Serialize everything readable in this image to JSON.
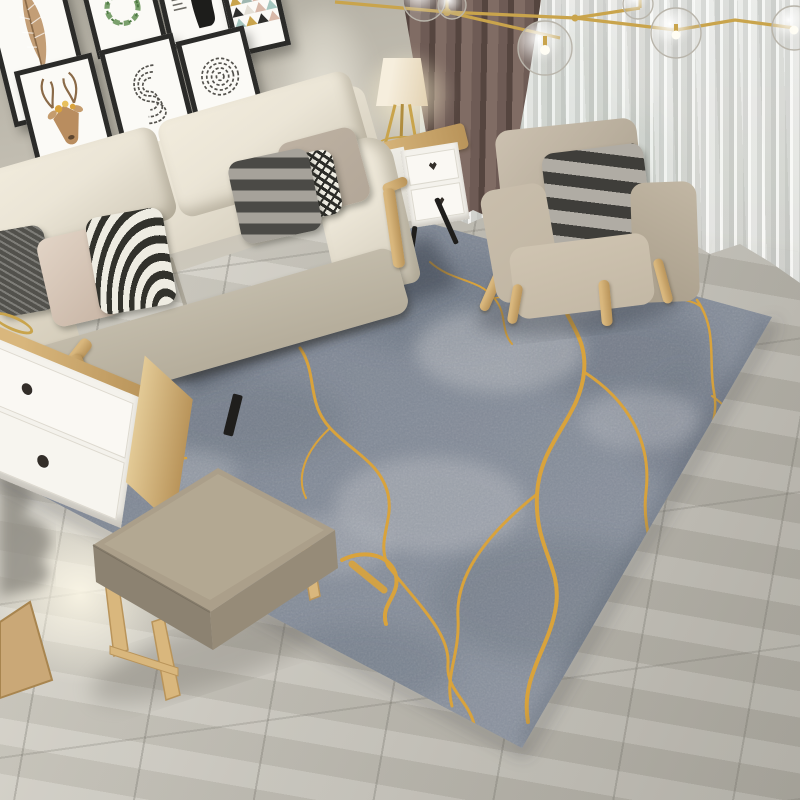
{
  "scene": {
    "description": "Modern living room product photograph showcasing a gray area rug with gold kintsugi-style marble veining, cream fabric sofa, beige armchair, ottoman, white side table with tripod lamp, gallery wall of black frames, brown blackout curtain and white sheer over a window, glass-globe branch pendant light, gray wood-tile floor",
    "focal_product": "gray and gold abstract marble rug"
  },
  "colors": {
    "wall": "#c9c4b8",
    "wall-shadow": "#b1ada1",
    "floor-light": "#dbd8ce",
    "floor-mid": "#c4c1b8",
    "floor-dark": "#a9a69d",
    "rug-base": "#7b8492",
    "rug-light": "#979eaa",
    "rug-pale": "#c6c8cb",
    "rug-dark": "#5d6674",
    "rug-vein": "#d9a33c",
    "curtain-dark": "#6e5b55",
    "curtain-darker": "#55453f",
    "curtain-light": "#806c64",
    "sheer-light": "#f2f2ef",
    "sheer-mid": "#d4d5d1",
    "window-green": "#6f9a85",
    "window-green-dark": "#4d7e6d",
    "window-sky": "#ccdcde",
    "sofa-cream": "#ebe5d6",
    "sofa-shadow": "#d0c9b8",
    "sofa-deep": "#c2bbaa",
    "pillow-dark": "#52514c",
    "pillow-blush-a": "#e2d4c6",
    "pillow-blush-b": "#c7b4a4",
    "stripe-dark": "#32322c",
    "stripe-light": "#eeece2",
    "pillow-gray-light": "#a6a29a",
    "pillow-gray-dark": "#4b4a46",
    "pillow-taupe": "#b3a798",
    "chair-beige": "#c0b5a2",
    "chair-beige-dark": "#a79d8b",
    "chair-seat": "#c3b8a5",
    "wood": "#d9b77d",
    "wood-dark": "#b9945a",
    "gold": "#c9a44c",
    "white-furniture": "#f4f2ec",
    "knob": "#332e29",
    "leg-black": "#1f1e1c",
    "ottoman-top": "#ab9f8a",
    "ottoman-side": "#8c8271",
    "ottoman-front": "#968b78",
    "frame": "#2b2b29",
    "mat": "#fbfaf6",
    "art-green": "#7aa06c",
    "art-brown": "#b98d5f",
    "art-ink": "#55534e",
    "lamp-shade": "#f6eedd",
    "lamp-shade-dark": "#e3d2b2"
  },
  "objects": {
    "gallery_wall_frames": [
      "feather print",
      "green wreath print",
      "black silhouette poster",
      "pastel triangles print",
      "watercolor deer print",
      "S fingerprint print",
      "circular fingerprint print"
    ],
    "sofa_pillows": [
      "dark gray knit",
      "blush beige",
      "black-white optical stripe",
      "taupe",
      "black-white houndstooth",
      "gray charcoal stripe"
    ],
    "furniture": [
      "three-seat cream sofa",
      "beige armchair",
      "fabric ottoman bench",
      "white two-drawer side table",
      "tripod table lamp",
      "white tv cabinet",
      "glass globe branch chandelier"
    ]
  }
}
